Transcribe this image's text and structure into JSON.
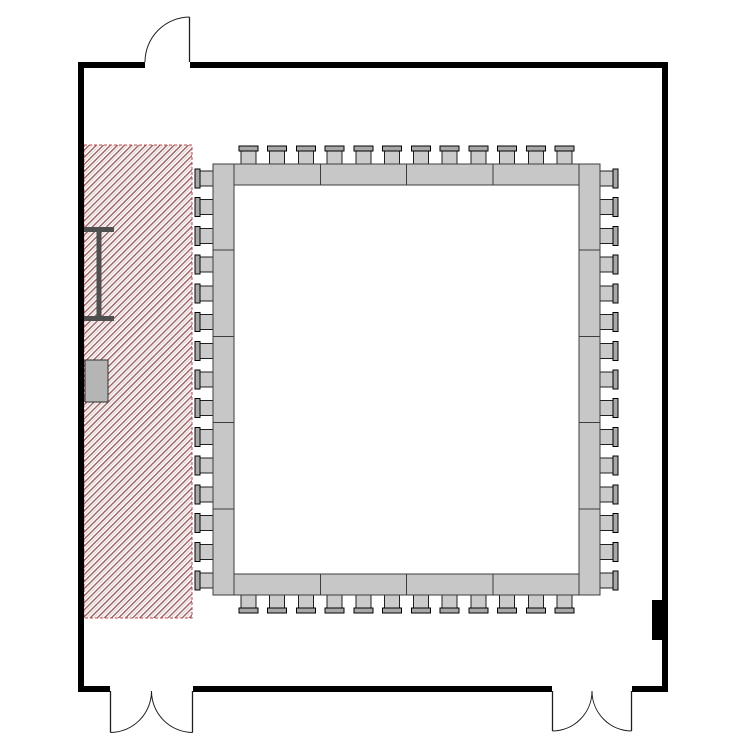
{
  "meta": {
    "view": "room-floor-plan",
    "canvas_width": 750,
    "canvas_height": 750,
    "background": "#ffffff"
  },
  "colors": {
    "wall": "#000000",
    "door_line": "#1f1f1f",
    "table_fill": "#c7c7c7",
    "table_stroke": "#3d3d3d",
    "chair_seat_fill": "#cbcbcb",
    "chair_seat_stroke": "#1f1f1f",
    "chair_back_fill": "#a8a8a8",
    "chair_back_stroke": "#000000",
    "stage_bg": "#ffffff",
    "stage_hatch_dark": "#a06868",
    "stage_hatch_light": "#e0cccc",
    "stage_border": "#c04848",
    "screen_fill": "#4f4f4f",
    "podium_fill": "#b5b5b5",
    "podium_stroke": "#2e2e2e",
    "panel_fill": "#000000"
  },
  "floorplan": {
    "room": {
      "x": 78,
      "y": 62,
      "width": 590,
      "height": 630,
      "wall_thickness": 6
    },
    "stage_area": {
      "x": 84,
      "y": 145,
      "width": 108,
      "height": 473,
      "hatch_spacing": 5
    },
    "conference_table": {
      "layout": "hollow-square",
      "outer": {
        "x": 213,
        "y": 164,
        "width": 387,
        "height": 431
      },
      "band_depth": 21,
      "segments": {
        "top": 4,
        "bottom": 4,
        "left": 5,
        "right": 5
      },
      "chairs": {
        "top": 12,
        "bottom": 12,
        "left": 15,
        "right": 15,
        "total": 54,
        "depth": 18,
        "back_thickness": 5,
        "back_width": 19,
        "seat_width": 15,
        "seat_depth": 13
      }
    },
    "projection_screen": {
      "x": 84,
      "cap_width": 30,
      "cap_thickness": 5,
      "top_y": 227,
      "bottom_y": 316,
      "bar_width": 5,
      "bar_center_x": 99
    },
    "podium": {
      "x": 85,
      "y": 360,
      "width": 23,
      "height": 42
    },
    "wall_panel": {
      "x": 652,
      "y": 600,
      "width": 13,
      "height": 40
    },
    "doors": [
      {
        "name": "top-entry-door",
        "style": "single",
        "wall": "top",
        "start": 145,
        "end": 190
      },
      {
        "name": "bottom-left-double-door",
        "style": "double",
        "wall": "bottom",
        "start": 110,
        "end": 193
      },
      {
        "name": "bottom-right-double-door",
        "style": "double",
        "wall": "bottom",
        "start": 552,
        "end": 632
      }
    ]
  }
}
